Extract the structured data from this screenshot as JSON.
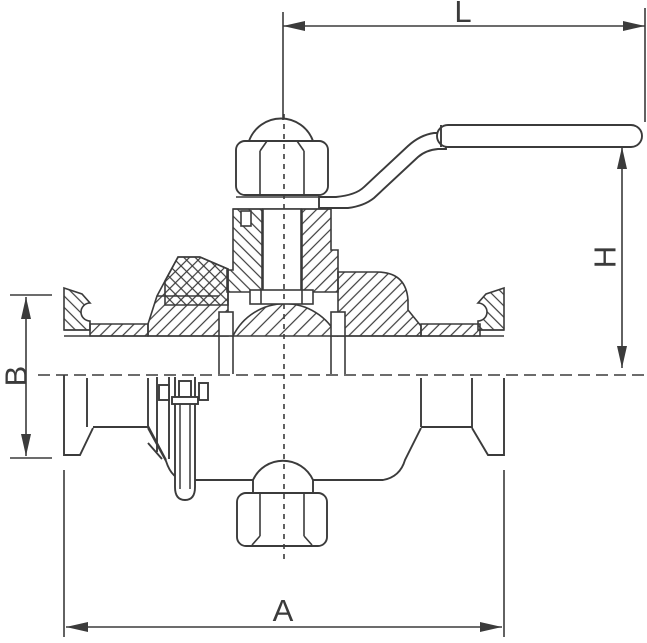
{
  "drawing": {
    "title": "Sanitary clamp-end ball valve - sectional technical drawing",
    "dimension_labels": {
      "top": "L",
      "right": "H",
      "left": "B",
      "bottom": "A"
    }
  },
  "colors": {
    "line": "#3b3b3b",
    "background": "#ffffff"
  }
}
